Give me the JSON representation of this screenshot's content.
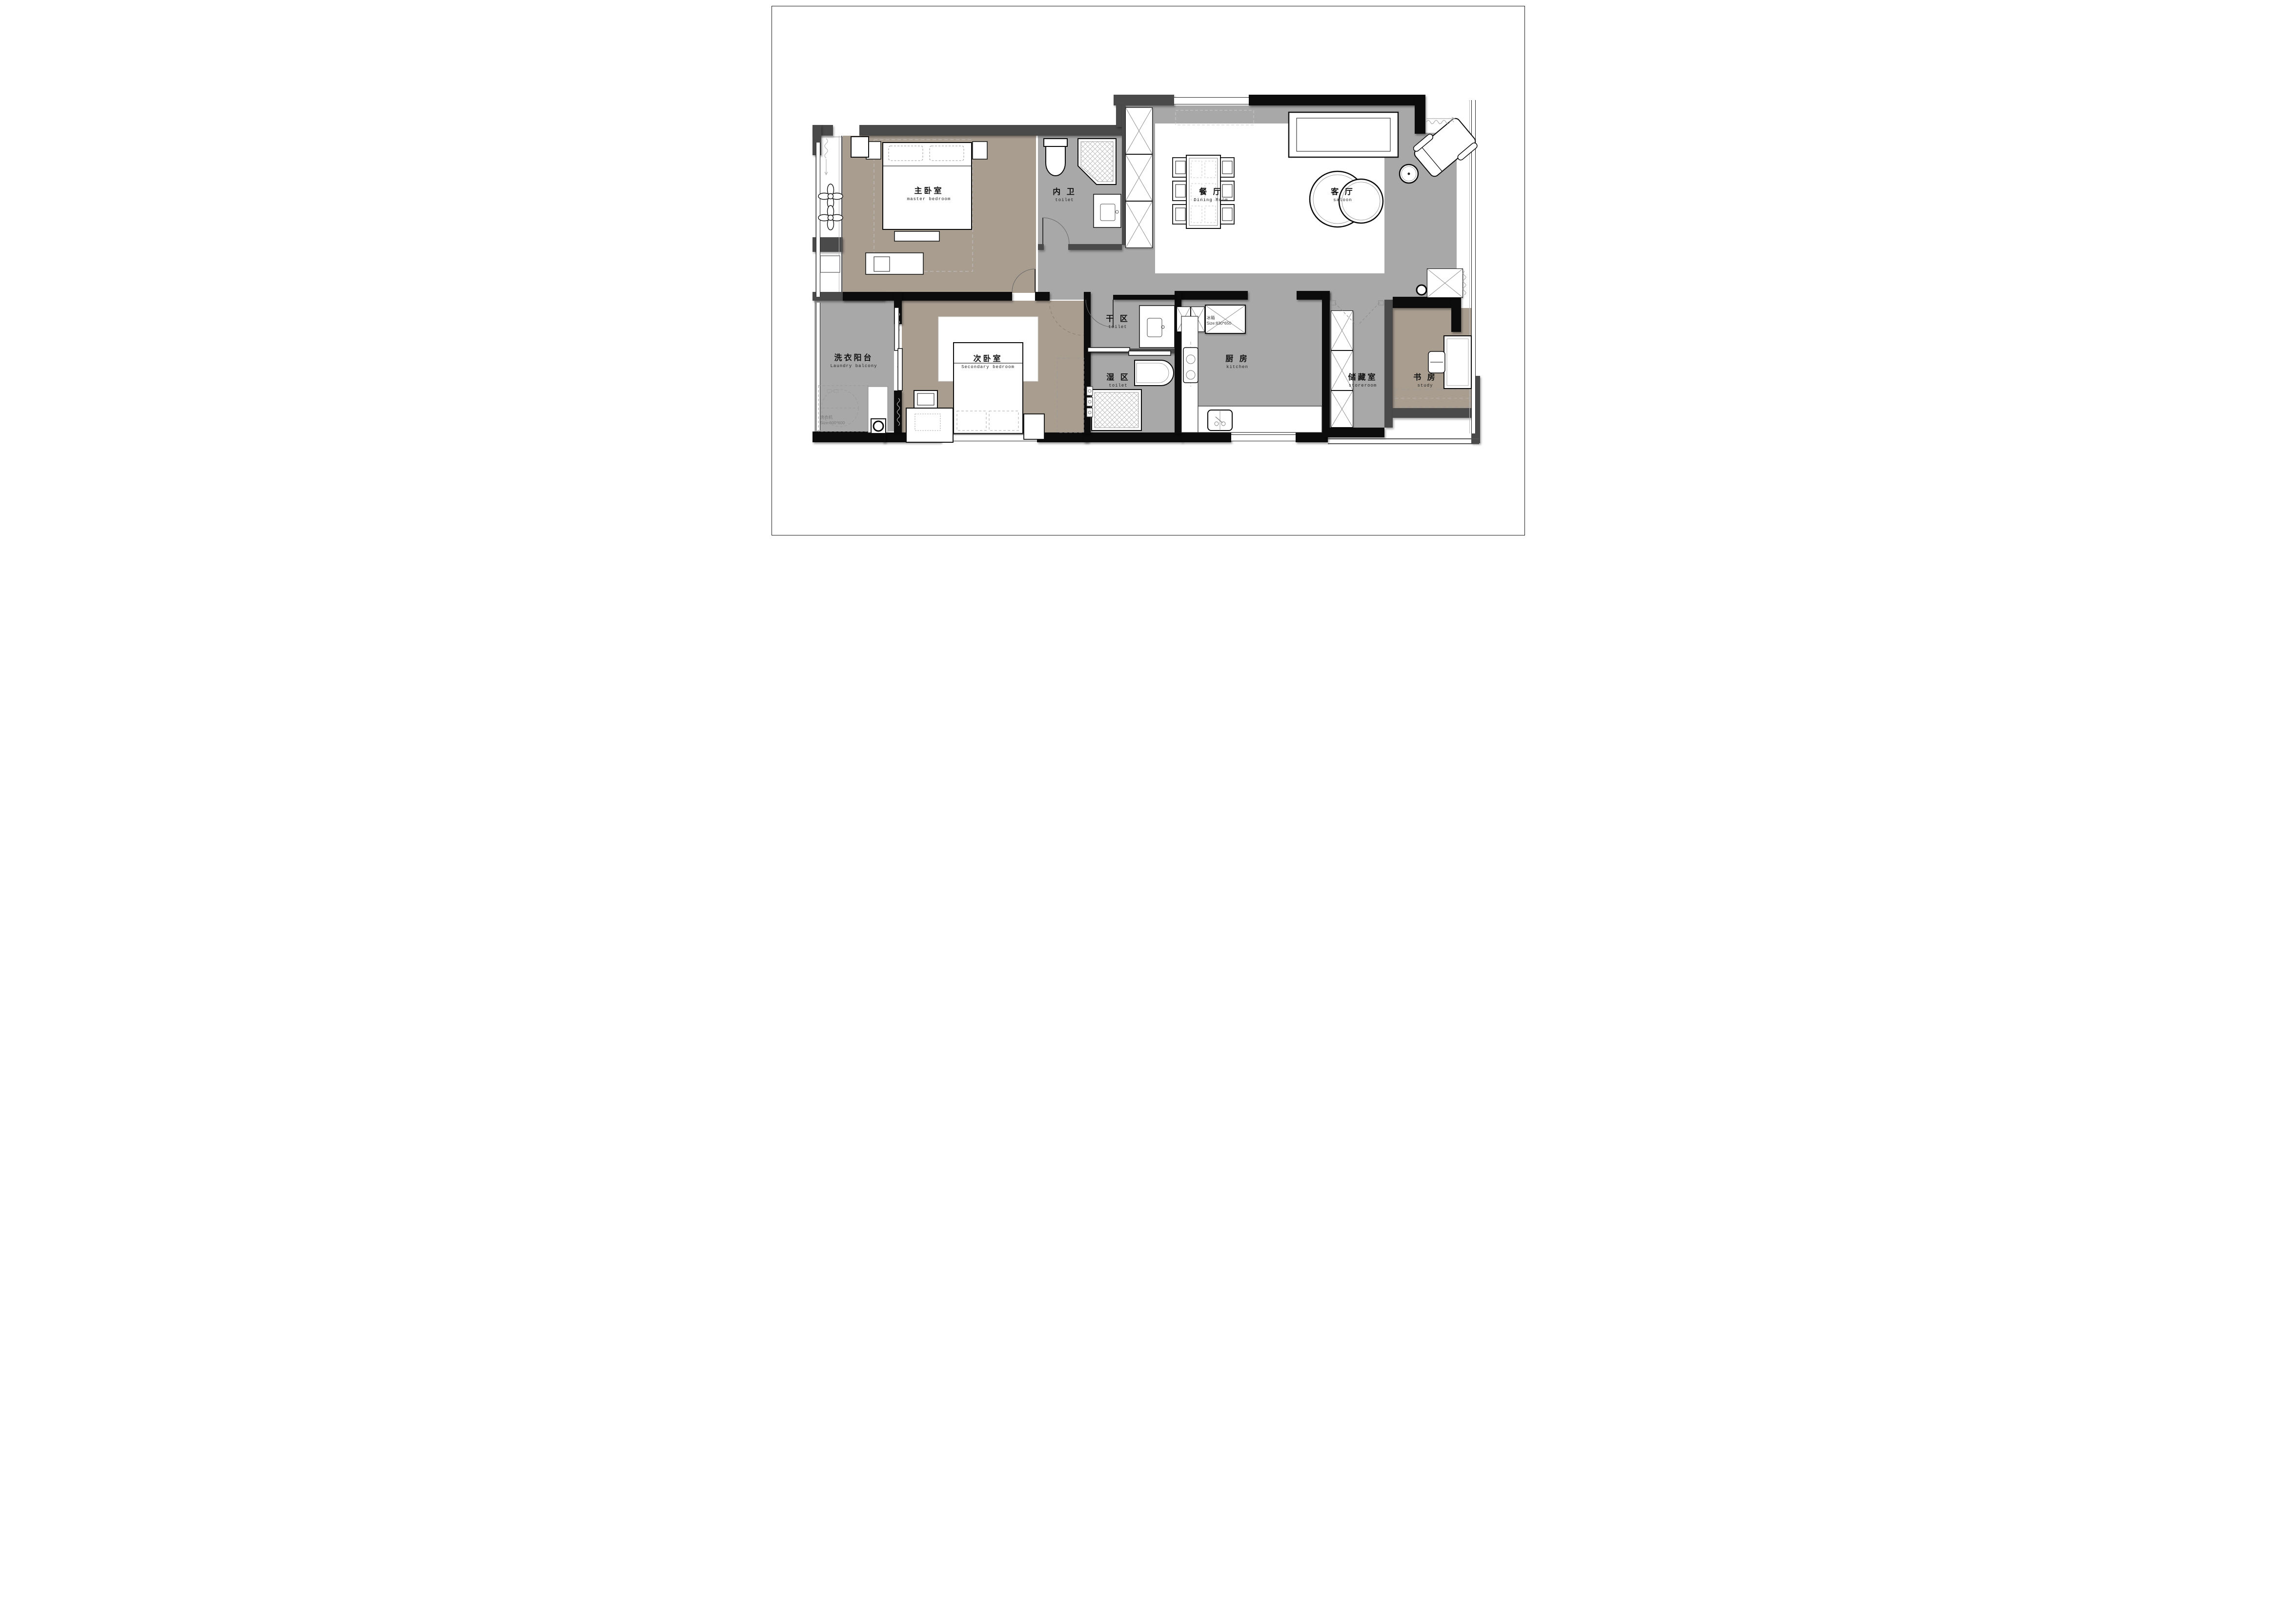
{
  "plan": {
    "title": "apartment floor plan",
    "colors": {
      "wall_black": "#0c0c0c",
      "wall_gray": "#4a4a4a",
      "floor_gray": "#a8a8a8",
      "floor_taupe": "#a99d90",
      "paper": "#ffffff"
    }
  },
  "rooms": [
    {
      "id": "master-bedroom",
      "zh": "主卧室",
      "en": "master bedroom"
    },
    {
      "id": "ensuite-toilet",
      "zh": "内 卫",
      "en": "toilet"
    },
    {
      "id": "dining-room",
      "zh": "餐 厅",
      "en": "Dining Room"
    },
    {
      "id": "living-room",
      "zh": "客 厅",
      "en": "saloon"
    },
    {
      "id": "laundry-balcony",
      "zh": "洗衣阳台",
      "en": "Laundry balcony"
    },
    {
      "id": "secondary-bedroom",
      "zh": "次卧室",
      "en": "Secondary bedroom"
    },
    {
      "id": "dry-area",
      "zh": "干 区",
      "en": "toilet"
    },
    {
      "id": "wet-area",
      "zh": "湿 区",
      "en": "toilet"
    },
    {
      "id": "kitchen",
      "zh": "厨 房",
      "en": "kitchen"
    },
    {
      "id": "storeroom",
      "zh": "储藏室",
      "en": "storeroom"
    },
    {
      "id": "study",
      "zh": "书 房",
      "en": "study"
    }
  ],
  "appliances": [
    {
      "id": "fridge",
      "zh": "冰箱",
      "size_label": "Size:830*650"
    },
    {
      "id": "washer",
      "zh": "洗衣机",
      "size_label": "Size:600*600"
    }
  ]
}
